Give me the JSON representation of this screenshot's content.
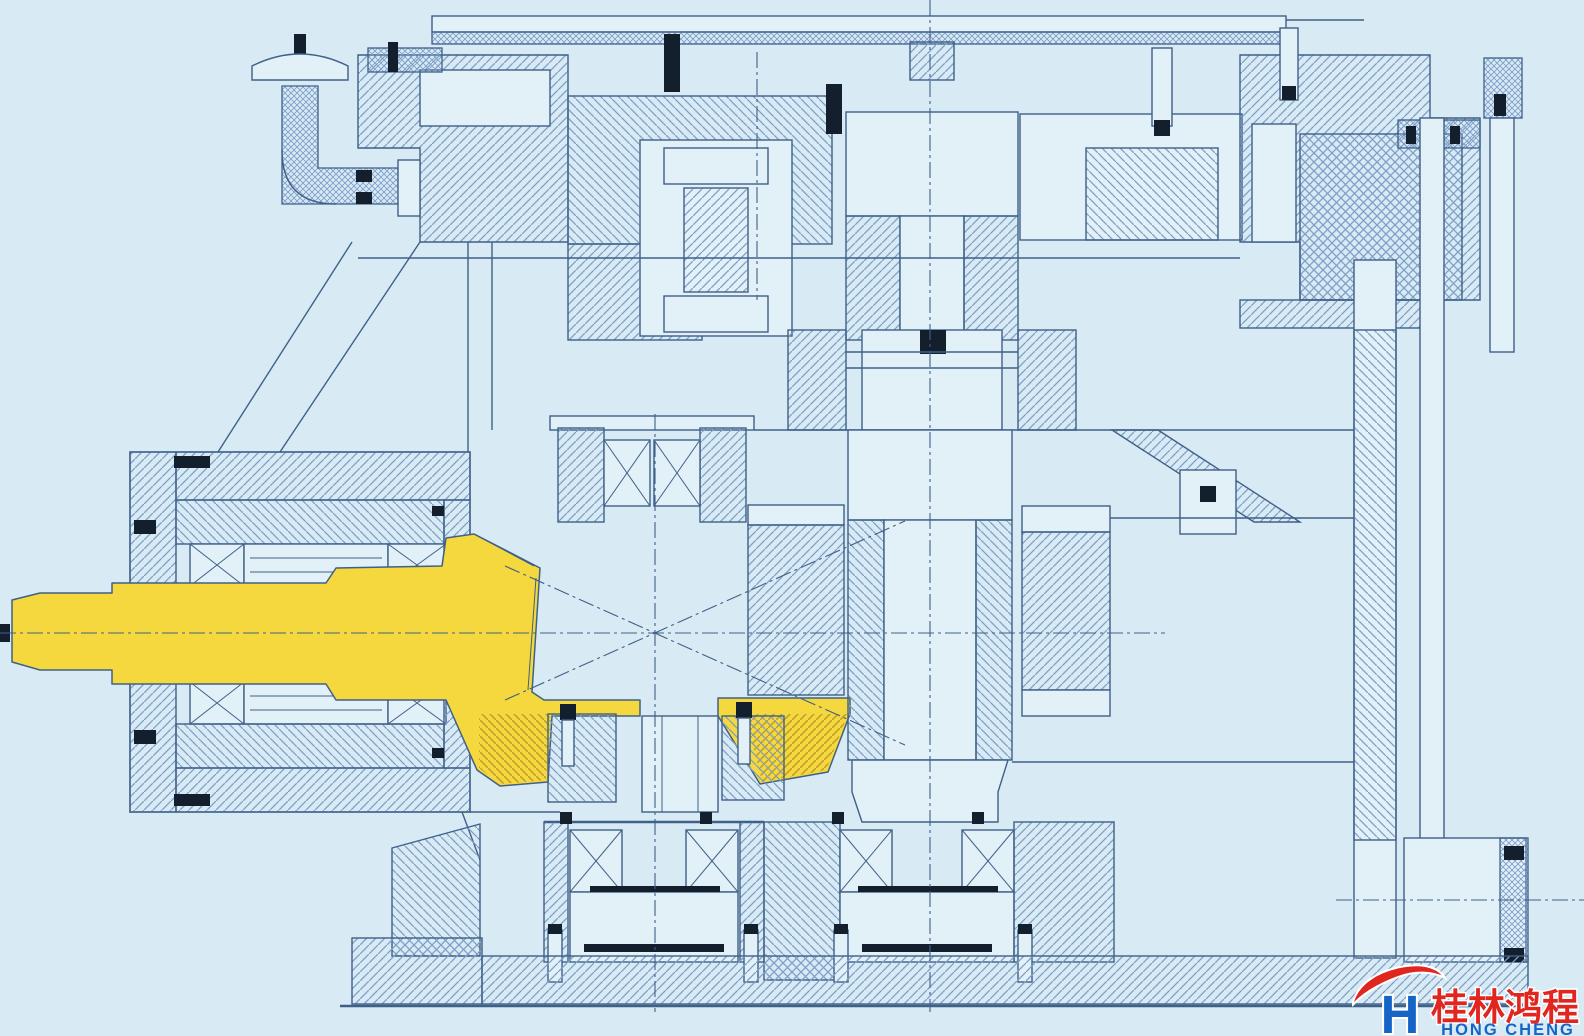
{
  "colors": {
    "background": "#d8ebf5",
    "paper": "#e2f0f8",
    "line": "#3f6088",
    "hatch": "#7f9ec6",
    "dark": "#141f2e",
    "highlight": "#f4d83d",
    "highlight_hatch": "#c2a02b"
  },
  "logo": {
    "letter": "H",
    "company_zh": "桂林鸿程",
    "company_en": "HONG CHENG",
    "swoosh_icon": "red-swoosh-icon",
    "colors": {
      "red": "#e1251f",
      "blue": "#1565c8"
    }
  }
}
